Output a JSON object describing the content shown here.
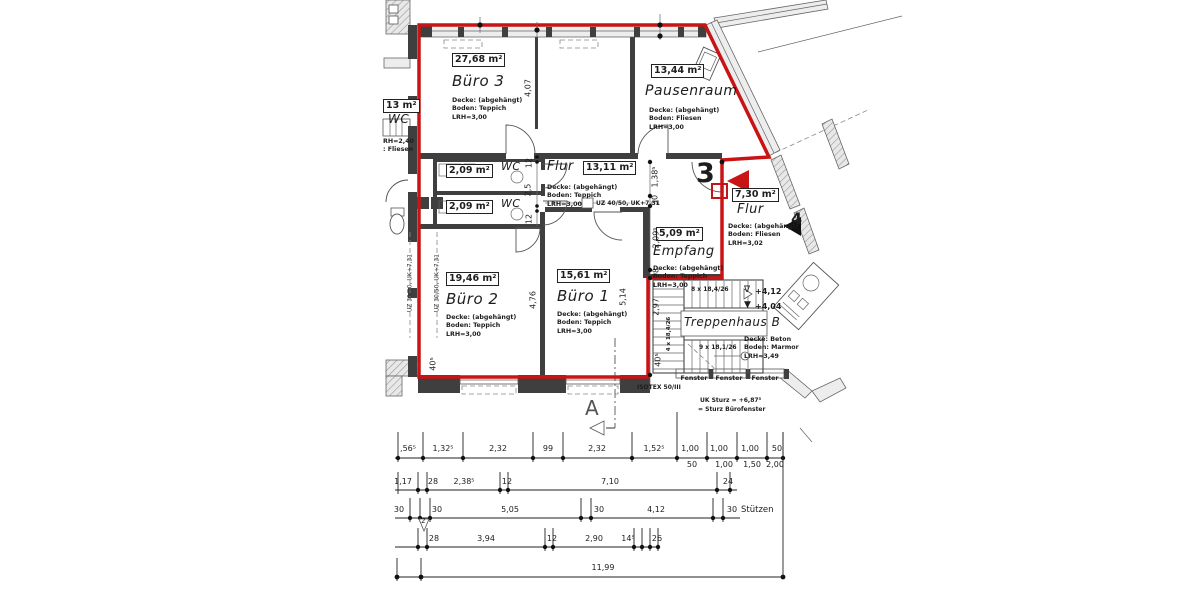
{
  "colors": {
    "boundary_red": "#c81414",
    "wall_dark": "#3f3f3f",
    "text": "#1d1d1d"
  },
  "rooms": {
    "buero3": {
      "area": "27,68 m²",
      "name": "Büro 3",
      "note1": "Decke: (abgehängt)",
      "note2": "Boden: Teppich",
      "note3": "LRH=3,00"
    },
    "pausenraum": {
      "area": "13,44 m²",
      "name": "Pausenraum",
      "note1": "Decke: (abgehängt)",
      "note2": "Boden: Fliesen",
      "note3": "LRH=3,00"
    },
    "flur_mid": {
      "area": "13,11 m²",
      "name": "Flur",
      "note1": "Decke: (abgehängt)",
      "note2": "Boden: Teppich",
      "note3": "LRH=3,00"
    },
    "wc_a": {
      "area": "2,09 m²",
      "name": "WC"
    },
    "wc_b": {
      "area": "2,09 m²",
      "name": "WC"
    },
    "wc_left": {
      "area": "13 m²",
      "name": "WC",
      "note1": "RH=2,40",
      "note2": ": Fliesen"
    },
    "buero2": {
      "area": "19,46 m²",
      "name": "Büro 2",
      "note1": "Decke: (abgehängt)",
      "note2": "Boden: Teppich",
      "note3": "LRH=3,00"
    },
    "buero1": {
      "area": "15,61 m²",
      "name": "Büro 1",
      "note1": "Decke: (abgehängt)",
      "note2": "Boden: Teppich",
      "note3": "LRH=3,00"
    },
    "empfang": {
      "area": "5,09 m²",
      "name": "Empfang",
      "note1": "Decke: (abgehängt)",
      "note2": "Boden: Teppich",
      "note3": "LRH=3,00"
    },
    "flur_right": {
      "area": "7,30 m²",
      "name": "Flur",
      "note1": "Decke: (abgehängt)",
      "note2": "Boden: Fliesen",
      "note3": "LRH=3,02"
    },
    "treppenhaus": {
      "name": "Treppenhaus B",
      "note1": "Decke: Beton",
      "note2": "Boden: Marmor",
      "note3": "LRH=3,49"
    }
  },
  "stairs": {
    "run_top": "8 x 18,4/26",
    "run_low": "9 x 18,1/26",
    "run_left": "4 x 18,4/26",
    "level_up_icon": "∇",
    "level_up": "+4,12",
    "level_down_icon": "▼",
    "level_down": "+4,04"
  },
  "markers": {
    "unit3": "3",
    "unit4": "4",
    "section": "A",
    "pillar2": "2"
  },
  "beams": {
    "left_a": "UZ 30/50, UK+7,31",
    "left_b": "UZ 30/50, UK+7,31",
    "corridor": "UZ 40/50, UK+7,31"
  },
  "notes": {
    "isotex": "ISOTEX 50/III",
    "fenster1": "Fenster",
    "fenster2": "Fenster",
    "fenster3": "Fenster",
    "sturz_line1": "UK Sturz = +6,87⁵",
    "sturz_line2": "= Sturz Bürofenster",
    "stuetzen": "Stützen"
  },
  "vdims": {
    "b3_h": "4,07",
    "wc_top": "12",
    "wc_mid": "2,5",
    "wc_bot": "12",
    "e_138": "1,38⁵",
    "e_30": "30",
    "e_209": "2,09⁵",
    "e_28": "28",
    "e_297": "2,97",
    "e_405": "40⁵",
    "b2_h": "4,76",
    "b1_h": "5,14",
    "bl_405": "40⁵"
  },
  "dim_rows": {
    "r1_top": [
      ",56⁵",
      "1,32⁵",
      "2,32",
      "99",
      "2,32",
      "1,52⁵",
      "1,00",
      "1,00",
      "1,00",
      "50"
    ],
    "r1_bot": [
      "50",
      "1,00",
      "1,50",
      "2,00"
    ],
    "r2": [
      "1,17",
      "28",
      "2,38⁵",
      "12",
      "7,10",
      "24"
    ],
    "r3": [
      "30",
      "30",
      "5,05",
      "30",
      "4,12",
      "30"
    ],
    "r4": [
      "28",
      "3,94",
      "12",
      "2,90",
      "14⁵",
      "26"
    ],
    "r5": [
      "11,99"
    ]
  }
}
